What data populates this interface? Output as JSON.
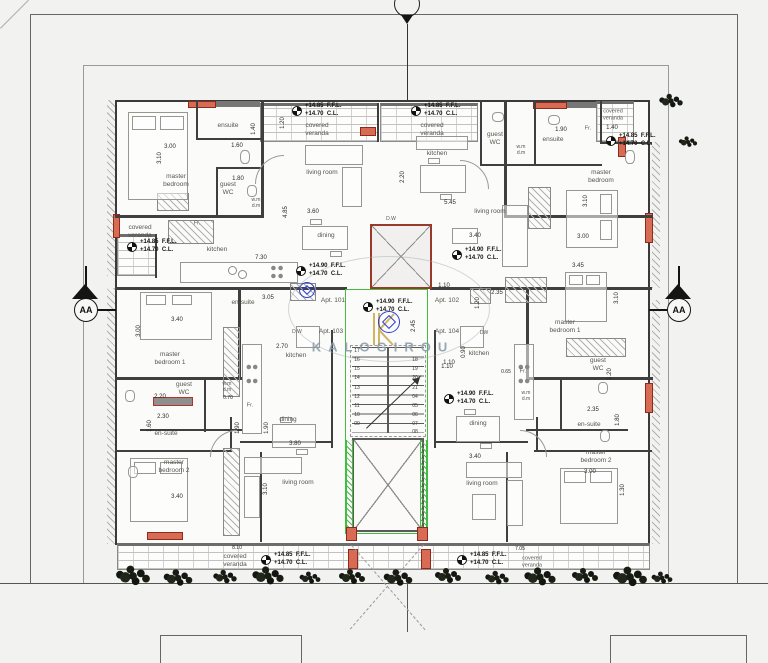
{
  "watermark": {
    "text": "KALOGIROU",
    "logo": "stylized-K"
  },
  "section_labels": {
    "left": "AA",
    "right": "AA"
  },
  "colors": {
    "accent_red": "#d76b54",
    "accent_green": "#41bd41",
    "stamp_blue": "#2b3fd4",
    "gold": "#c9a23f",
    "paper": "#f2f3f0"
  },
  "apartments": [
    "Apt. 101",
    "Apt. 102",
    "Apt. 103",
    "Apt. 104"
  ],
  "room_labels": [
    {
      "t": "ensuite",
      "x": 228,
      "y": 126
    },
    {
      "t": "master\nbedroom",
      "x": 176,
      "y": 181
    },
    {
      "t": "guest\nWC",
      "x": 228,
      "y": 189
    },
    {
      "t": "w.m\nd.m",
      "x": 256,
      "y": 203,
      "fs": 5
    },
    {
      "t": "covered\nveranda",
      "x": 140,
      "y": 232
    },
    {
      "t": "Fr.",
      "x": 197,
      "y": 224,
      "fs": 5.5
    },
    {
      "t": "kitchen",
      "x": 217,
      "y": 250
    },
    {
      "t": "living room",
      "x": 322,
      "y": 173
    },
    {
      "t": "dining",
      "x": 326,
      "y": 236
    },
    {
      "t": "covered\nveranda",
      "x": 317,
      "y": 130
    },
    {
      "t": "covered\nveranda",
      "x": 432,
      "y": 130
    },
    {
      "t": "kitchen",
      "x": 437,
      "y": 154
    },
    {
      "t": "guest\nWC",
      "x": 495,
      "y": 139
    },
    {
      "t": "w.m\nd.m",
      "x": 521,
      "y": 150,
      "fs": 5
    },
    {
      "t": "ensuite",
      "x": 553,
      "y": 140
    },
    {
      "t": "Fr.",
      "x": 588,
      "y": 129,
      "fs": 5.5
    },
    {
      "t": "master\nbedroom",
      "x": 601,
      "y": 177
    },
    {
      "t": "living room",
      "x": 490,
      "y": 212
    },
    {
      "t": "D.W",
      "x": 391,
      "y": 219,
      "fs": 5
    },
    {
      "t": "covered\nveranda",
      "x": 613,
      "y": 115,
      "fs": 5.5
    },
    {
      "t": "Apt. 101",
      "x": 333,
      "y": 301
    },
    {
      "t": "Apt. 102",
      "x": 447,
      "y": 301
    },
    {
      "t": "Apt. 103",
      "x": 331,
      "y": 332
    },
    {
      "t": "Apt. 104",
      "x": 447,
      "y": 332
    },
    {
      "t": "en-suite",
      "x": 243,
      "y": 303
    },
    {
      "t": "master\nbedroom 1",
      "x": 170,
      "y": 359
    },
    {
      "t": "D.W",
      "x": 297,
      "y": 332,
      "fs": 5
    },
    {
      "t": "kitchen",
      "x": 296,
      "y": 356
    },
    {
      "t": "guest\nWC",
      "x": 184,
      "y": 389
    },
    {
      "t": "w.m\nd.m",
      "x": 227,
      "y": 387,
      "fs": 5
    },
    {
      "t": "Fr.",
      "x": 250,
      "y": 406,
      "fs": 5.5
    },
    {
      "t": "en-suite",
      "x": 166,
      "y": 434
    },
    {
      "t": "master\nbedroom 2",
      "x": 174,
      "y": 467
    },
    {
      "t": "living room",
      "x": 298,
      "y": 483
    },
    {
      "t": "covered\nveranda",
      "x": 235,
      "y": 561
    },
    {
      "t": "kitchen",
      "x": 479,
      "y": 354
    },
    {
      "t": "DW",
      "x": 484,
      "y": 333,
      "fs": 5
    },
    {
      "t": "Fr.",
      "x": 523,
      "y": 372,
      "fs": 5.5
    },
    {
      "t": "w.m\nd.m",
      "x": 526,
      "y": 396,
      "fs": 5
    },
    {
      "t": "guest\nWC",
      "x": 598,
      "y": 365
    },
    {
      "t": "dining",
      "x": 478,
      "y": 424
    },
    {
      "t": "en-suite",
      "x": 589,
      "y": 425
    },
    {
      "t": "master\nbedroom 2",
      "x": 596,
      "y": 457
    },
    {
      "t": "master\nbedroom 1",
      "x": 565,
      "y": 327
    },
    {
      "t": "dining",
      "x": 288,
      "y": 420
    },
    {
      "t": "living room",
      "x": 482,
      "y": 484
    },
    {
      "t": "covered\nveranda",
      "x": 532,
      "y": 562,
      "fs": 5.5
    }
  ],
  "dim_labels": [
    {
      "t": "3.00",
      "x": 170,
      "y": 147
    },
    {
      "t": "3.10",
      "x": 160,
      "y": 158,
      "rot": -90
    },
    {
      "t": "1.60",
      "x": 237,
      "y": 146
    },
    {
      "t": "1.40",
      "x": 254,
      "y": 129,
      "rot": -90
    },
    {
      "t": "1.80",
      "x": 238,
      "y": 179
    },
    {
      "t": "3.60",
      "x": 313,
      "y": 212
    },
    {
      "t": "7.30",
      "x": 261,
      "y": 258
    },
    {
      "t": "4.85",
      "x": 286,
      "y": 212,
      "rot": -90
    },
    {
      "t": "1.20",
      "x": 283,
      "y": 123,
      "rot": -90
    },
    {
      "t": "5.45",
      "x": 450,
      "y": 203
    },
    {
      "t": "3.40",
      "x": 475,
      "y": 236
    },
    {
      "t": "2.20",
      "x": 403,
      "y": 177,
      "rot": -90
    },
    {
      "t": "1.90",
      "x": 561,
      "y": 130
    },
    {
      "t": "1.40",
      "x": 612,
      "y": 128
    },
    {
      "t": "3.10",
      "x": 586,
      "y": 201,
      "rot": -90
    },
    {
      "t": "3.00",
      "x": 583,
      "y": 237
    },
    {
      "t": "3.45",
      "x": 578,
      "y": 266
    },
    {
      "t": "1.10",
      "x": 444,
      "y": 286
    },
    {
      "t": "2.35",
      "x": 497,
      "y": 293
    },
    {
      "t": "1.20",
      "x": 478,
      "y": 303,
      "rot": -90
    },
    {
      "t": "3.10",
      "x": 617,
      "y": 298,
      "rot": -90
    },
    {
      "t": "3.05",
      "x": 268,
      "y": 298
    },
    {
      "t": "3.40",
      "x": 177,
      "y": 320
    },
    {
      "t": "3.00",
      "x": 139,
      "y": 331,
      "rot": -90
    },
    {
      "t": "2.70",
      "x": 282,
      "y": 347
    },
    {
      "t": "2.20",
      "x": 160,
      "y": 397
    },
    {
      "t": "2.30",
      "x": 163,
      "y": 417
    },
    {
      "t": "1.60",
      "x": 150,
      "y": 426,
      "rot": -90
    },
    {
      "t": "0.70",
      "x": 228,
      "y": 398,
      "fs": 5
    },
    {
      "t": "0.65",
      "x": 506,
      "y": 372,
      "fs": 5
    },
    {
      "t": "0.90",
      "x": 464,
      "y": 352,
      "rot": -90
    },
    {
      "t": "1.10",
      "x": 449,
      "y": 363
    },
    {
      "t": "2.35",
      "x": 593,
      "y": 410
    },
    {
      "t": "1.80",
      "x": 618,
      "y": 420,
      "rot": -90
    },
    {
      "t": "3.00",
      "x": 590,
      "y": 472
    },
    {
      "t": "3.40",
      "x": 177,
      "y": 497
    },
    {
      "t": "3.10",
      "x": 266,
      "y": 489,
      "rot": -90
    },
    {
      "t": "3.80",
      "x": 295,
      "y": 444
    },
    {
      "t": "1.90",
      "x": 238,
      "y": 428,
      "rot": -90
    },
    {
      "t": "1.90",
      "x": 267,
      "y": 428,
      "rot": -90
    },
    {
      "t": "3.40",
      "x": 475,
      "y": 457
    },
    {
      "t": "8.10",
      "x": 237,
      "y": 548,
      "fs": 5
    },
    {
      "t": "7.05",
      "x": 520,
      "y": 549,
      "fs": 5
    },
    {
      "t": "2.45",
      "x": 414,
      "y": 326,
      "rot": -90
    },
    {
      "t": "1.10",
      "x": 447,
      "y": 367
    },
    {
      "t": "1.20",
      "x": 610,
      "y": 374,
      "rot": -90
    },
    {
      "t": "1.30",
      "x": 623,
      "y": 490,
      "rot": -90
    }
  ],
  "step_labels": [
    {
      "t": "17",
      "x": 357,
      "y": 351
    },
    {
      "t": "16",
      "x": 357,
      "y": 360
    },
    {
      "t": "15",
      "x": 357,
      "y": 369
    },
    {
      "t": "14",
      "x": 357,
      "y": 378
    },
    {
      "t": "13",
      "x": 357,
      "y": 388
    },
    {
      "t": "12",
      "x": 357,
      "y": 397
    },
    {
      "t": "11",
      "x": 357,
      "y": 406
    },
    {
      "t": "10",
      "x": 357,
      "y": 415
    },
    {
      "t": "09",
      "x": 357,
      "y": 424
    },
    {
      "t": "18",
      "x": 415,
      "y": 360
    },
    {
      "t": "19",
      "x": 415,
      "y": 369
    },
    {
      "t": "20",
      "x": 415,
      "y": 378
    },
    {
      "t": "21",
      "x": 415,
      "y": 388
    },
    {
      "t": "04",
      "x": 415,
      "y": 397
    },
    {
      "t": "05",
      "x": 415,
      "y": 406
    },
    {
      "t": "06",
      "x": 415,
      "y": 415
    },
    {
      "t": "07",
      "x": 415,
      "y": 424
    },
    {
      "t": "08",
      "x": 415,
      "y": 432
    }
  ],
  "level_markers": [
    {
      "x": 297,
      "y": 111,
      "l1": "+14.85  F.F.L.",
      "l2": "+14.70  C.L."
    },
    {
      "x": 416,
      "y": 111,
      "l1": "+14.85  F.F.L.",
      "l2": "+14.70  C.L."
    },
    {
      "x": 611,
      "y": 141,
      "l1": "+14.85  F.F.L.",
      "l2": "+14.70  C.L."
    },
    {
      "x": 132,
      "y": 247,
      "l1": "+14.85  F.F.L.",
      "l2": "+14.70  C.L."
    },
    {
      "x": 301,
      "y": 271,
      "l1": "+14.90  F.F.L.",
      "l2": "+14.70  C.L."
    },
    {
      "x": 457,
      "y": 255,
      "l1": "+14.90  F.F.L.",
      "l2": "+14.70  C.L."
    },
    {
      "x": 368,
      "y": 307,
      "l1": "+14.90  F.F.L.",
      "l2": "+14.70  C.L."
    },
    {
      "x": 449,
      "y": 399,
      "l1": "+14.90  F.F.L.",
      "l2": "+14.70  C.L."
    },
    {
      "x": 266,
      "y": 560,
      "l1": "+14.85  F.F.L.",
      "l2": "+14.70  C.L."
    },
    {
      "x": 462,
      "y": 560,
      "l1": "+14.85  F.F.L.",
      "l2": "+14.70  C.L."
    }
  ],
  "plants": [
    {
      "x": 133,
      "y": 576,
      "s": 1.3
    },
    {
      "x": 178,
      "y": 578,
      "s": 1.1
    },
    {
      "x": 225,
      "y": 577,
      "s": 0.9
    },
    {
      "x": 268,
      "y": 576,
      "s": 1.2
    },
    {
      "x": 310,
      "y": 578,
      "s": 0.8
    },
    {
      "x": 352,
      "y": 577,
      "s": 1.0
    },
    {
      "x": 398,
      "y": 578,
      "s": 1.1
    },
    {
      "x": 448,
      "y": 576,
      "s": 1.0
    },
    {
      "x": 497,
      "y": 578,
      "s": 0.9
    },
    {
      "x": 540,
      "y": 577,
      "s": 1.2
    },
    {
      "x": 585,
      "y": 576,
      "s": 1.0
    },
    {
      "x": 630,
      "y": 577,
      "s": 1.3
    },
    {
      "x": 662,
      "y": 578,
      "s": 0.8
    },
    {
      "x": 671,
      "y": 101,
      "s": 0.9
    },
    {
      "x": 688,
      "y": 142,
      "s": 0.7
    }
  ]
}
